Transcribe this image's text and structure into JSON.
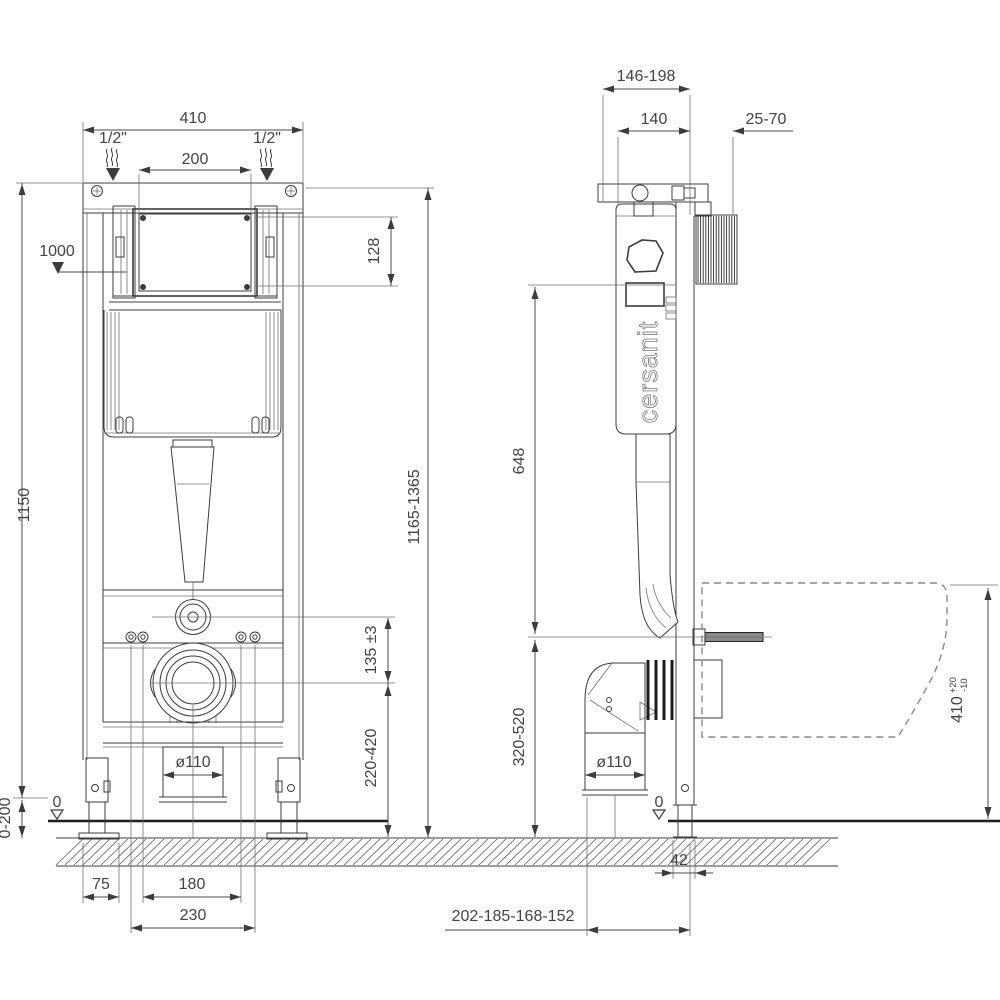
{
  "drawing": {
    "type": "technical-installation-diagram",
    "brand": "cersanit"
  },
  "front_view": {
    "dims": {
      "width": "410",
      "water_left": "1/2\"",
      "water_right": "1/2\"",
      "plate_width": "200",
      "button_height": "1000",
      "plate_height": "128",
      "frame_height": "1150",
      "total_height": "1165-1365",
      "outlet_offset": "135 ±3",
      "outlet_height": "220-420",
      "drain_diameter": "ø110",
      "zero_level": "0",
      "floor_range": "0-200",
      "foot_offset": "75",
      "bolt_spacing": "180",
      "fixing_spacing": "230"
    }
  },
  "side_view": {
    "brand": "cersanit",
    "dims": {
      "depth_range": "146-198",
      "frame_depth": "140",
      "wall_distance": "25-70",
      "inlet_height": "648",
      "outlet_range": "320-520",
      "drain_diameter": "ø110",
      "zero_level": "0",
      "foot_depth": "42",
      "outlet_depths": "202-185-168-152",
      "bowl_height": "410",
      "bowl_tol_upper": "+20",
      "bowl_tol_lower": "-10"
    }
  }
}
